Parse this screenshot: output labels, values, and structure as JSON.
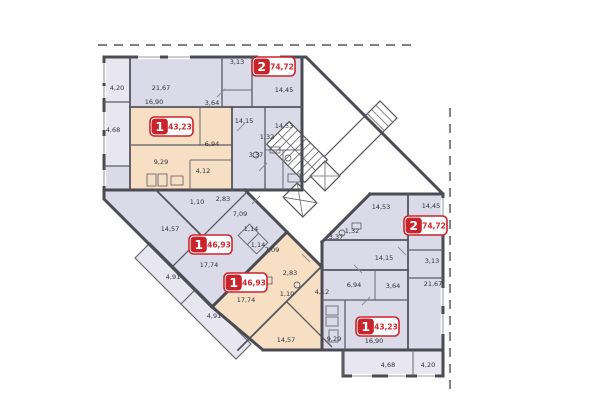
{
  "plan": {
    "kind": "residential-floor-plan",
    "colors": {
      "apartment_lavender": "#dbdae8",
      "apartment_peach": "#f7dfc4",
      "balcony": "#e8e7f1",
      "wall": "#4b4b54",
      "badge_red": "#c9242b",
      "badge_area_text": "#d8262d"
    }
  },
  "apartments": [
    {
      "id": "apt-2-top",
      "rooms": "2",
      "area": "74,72"
    },
    {
      "id": "apt-1-top-left",
      "rooms": "1",
      "area": "43,23"
    },
    {
      "id": "apt-1-middle-upper",
      "rooms": "1",
      "area": "46,93"
    },
    {
      "id": "apt-1-middle-lower",
      "rooms": "1",
      "area": "46,93"
    },
    {
      "id": "apt-2-right",
      "rooms": "2",
      "area": "74,72"
    },
    {
      "id": "apt-1-bottom-right",
      "rooms": "1",
      "area": "43,23"
    }
  ],
  "room_labels": [
    "4,20",
    "21,67",
    "3,13",
    "14,45",
    "4,68",
    "16,90",
    "3,64",
    "14,15",
    "14,53",
    "9,29",
    "6,94",
    "1,32",
    "3,37",
    "4,12",
    "1,10",
    "2,83",
    "7,09",
    "14,57",
    "17,74",
    "1,14",
    "1,14",
    "7,09",
    "4,91",
    "17,74",
    "2,83",
    "1,10",
    "4,12",
    "4,91",
    "14,57",
    "9,29",
    "6,94",
    "3,64",
    "14,53",
    "14,45",
    "1,32",
    "3,37",
    "14,15",
    "3,13",
    "21,67",
    "16,90",
    "4,68",
    "4,20"
  ]
}
